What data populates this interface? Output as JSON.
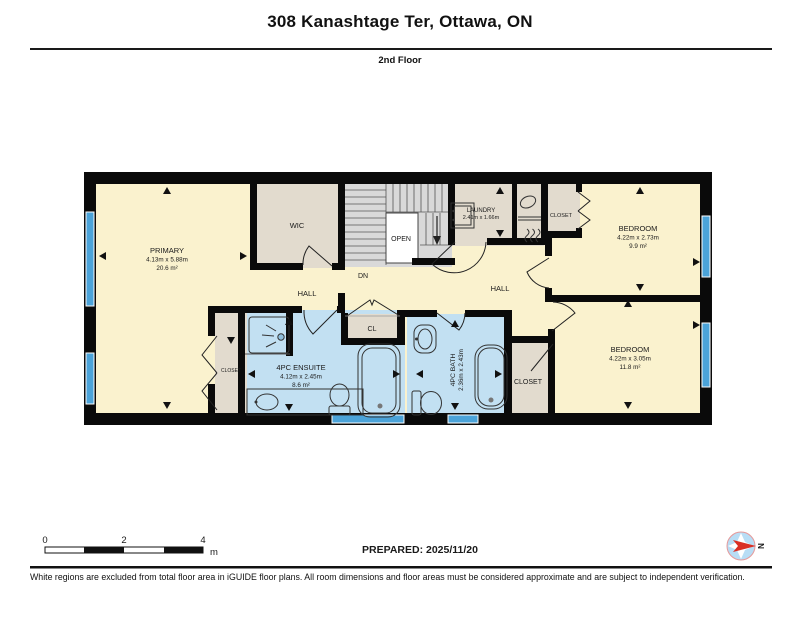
{
  "header": {
    "title": "308 Kanashtage Ter, Ottawa, ON",
    "floor_label": "2nd Floor"
  },
  "rooms": {
    "primary": {
      "name": "PRIMARY",
      "dims": "4.13m x 5.88m",
      "area": "20.6 m²"
    },
    "wic": {
      "name": "WIC"
    },
    "laundry": {
      "name": "LAUNDRY",
      "dims": "2.41m x 1.66m"
    },
    "closet_top_right": {
      "name": "CLOSET"
    },
    "bedroom_top_right": {
      "name": "BEDROOM",
      "dims": "4.22m x 2.73m",
      "area": "9.9 m²"
    },
    "hall_west": {
      "name": "HALL"
    },
    "hall_east": {
      "name": "HALL"
    },
    "cl": {
      "name": "CL"
    },
    "ensuite": {
      "name": "4PC ENSUITE",
      "dims": "4.12m x 2.45m",
      "area": "8.6 m²"
    },
    "bath": {
      "name": "4PC BATH",
      "dims": "2.36m x 2.43m"
    },
    "closet_primary": {
      "name": "CLOSET"
    },
    "closet_bottom_right": {
      "name": "CLOSET"
    },
    "bedroom_bottom_right": {
      "name": "BEDROOM",
      "dims": "4.22m x 3.05m",
      "area": "11.8 m²"
    },
    "stairs": {
      "open_label": "OPEN",
      "down_label": "DN"
    }
  },
  "scale_bar": {
    "tick_0": "0",
    "tick_2": "2",
    "tick_4": "4",
    "unit": "m"
  },
  "prepared": {
    "label": "PREPARED: 2025/11/20"
  },
  "compass": {
    "north_label": "N"
  },
  "disclaimer": "White regions are excluded from total floor area in iGUIDE floor plans. All room dimensions and floor areas must be considered approximate and are subject to independent verification.",
  "colors": {
    "room_fill": "#FAF2CE",
    "closet_fill": "#E2DBCE",
    "bath_fill": "#C2E0F2",
    "stairs_fill": "#D9D9D9",
    "window": "#4BA3D9",
    "wall": "#0A0A0A",
    "compass_arrow": "#D93025"
  }
}
